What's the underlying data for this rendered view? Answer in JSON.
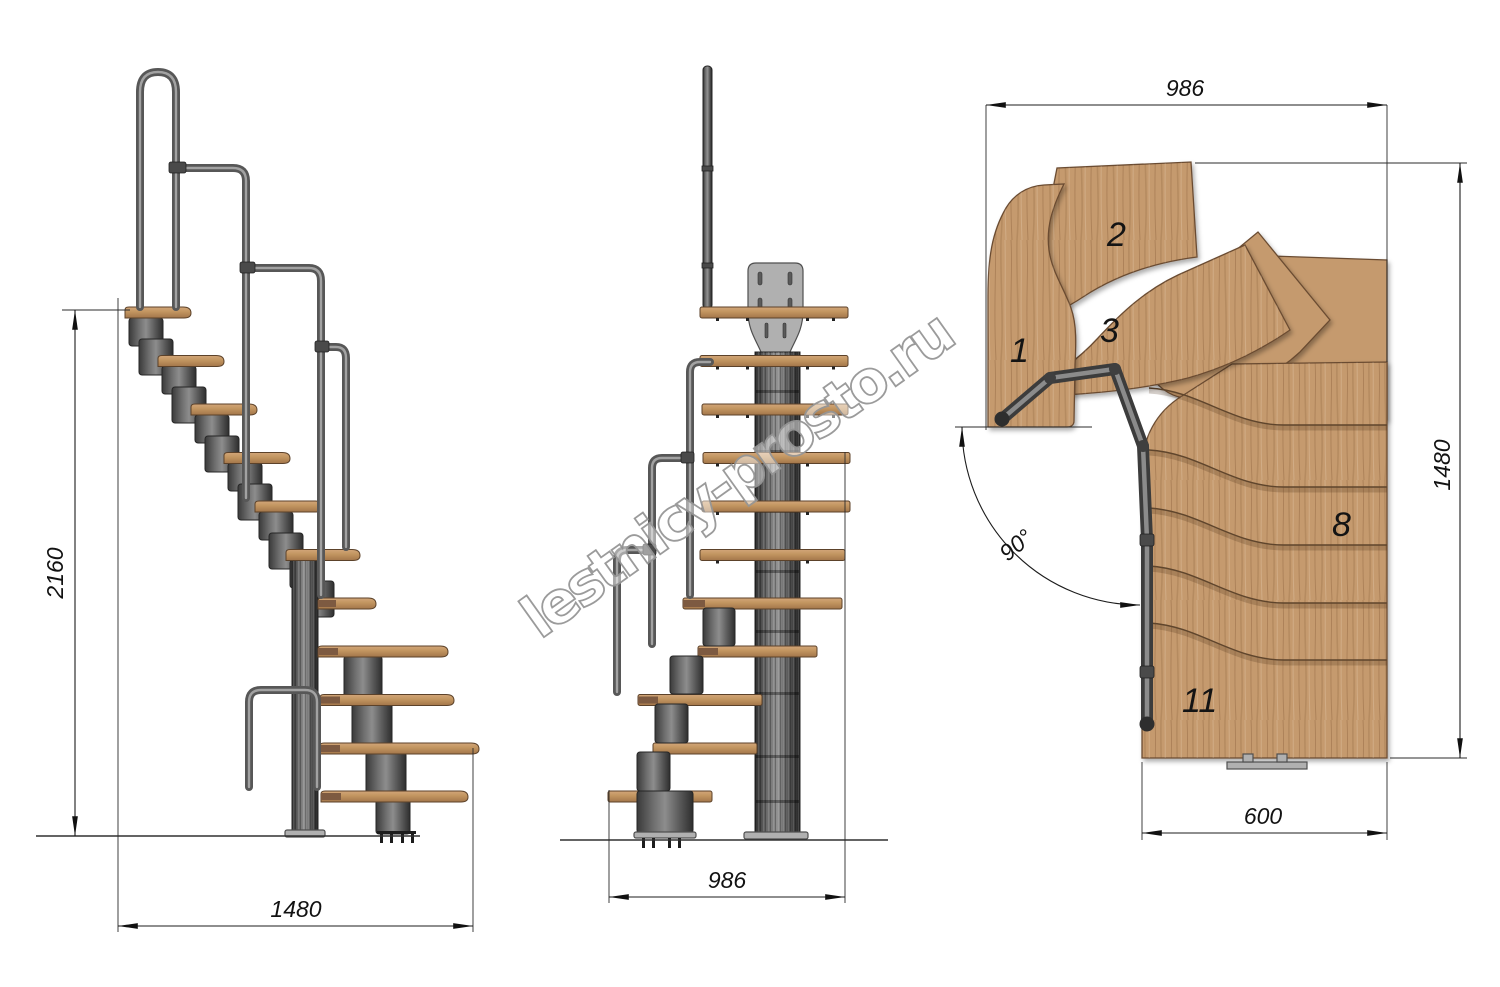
{
  "drawing": {
    "watermark": "lestnicy-prosto.ru",
    "side_view": {
      "height_dim": "2160",
      "run_dim": "1480"
    },
    "front_view": {
      "width_dim": "986"
    },
    "plan_view": {
      "width_dim": "986",
      "depth_dim": "1480",
      "exit_width_dim": "600",
      "turn_angle_dim": "90°",
      "step_numbers": [
        "1",
        "2",
        "3",
        "8",
        "11"
      ]
    },
    "colors": {
      "wood": "#c59a6e",
      "wood_edge": "#6b4c31",
      "metal": "#5f5f5f",
      "rail": "#707070",
      "mount_plate": "#b0b0b0",
      "dimension_line": "#1c1c1c",
      "watermark_gray": "#969696",
      "background": "#ffffff"
    }
  }
}
